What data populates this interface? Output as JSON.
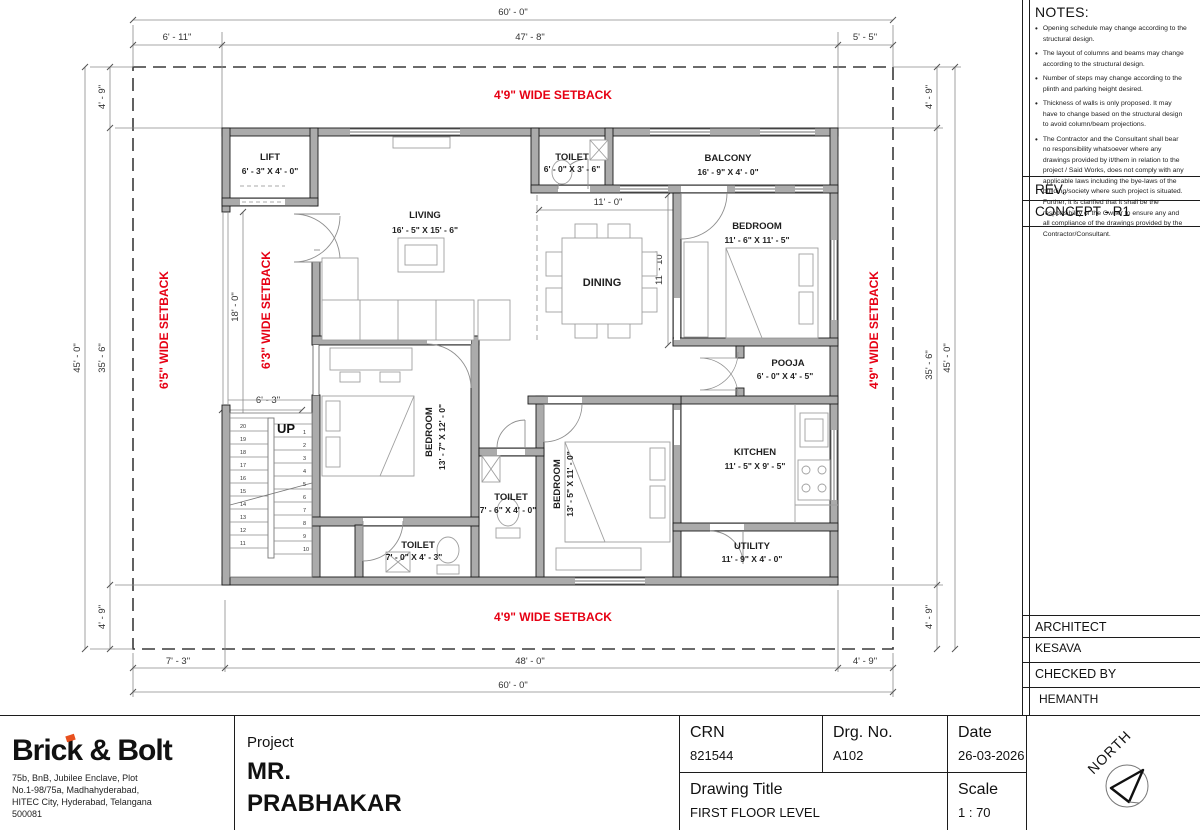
{
  "notes": {
    "title": "NOTES:",
    "items": [
      "Opening schedule may change according to the structural design.",
      "The layout of columns and beams may change according to the structural design.",
      "Number of steps may change according to the plinth and parking height desired.",
      "Thickness of walls is only proposed. It may have to change based on the structural design to avoid column/beam projections.",
      "The Contractor and the Consultant shall bear no responsibility whatsoever where any drawings provided by it/them in relation to the project / Said Works, does not comply with any applicable laws including the bye-laws of the building/society where such project is situated. Further, it is clarified that it shall be the responsibility of the Owner to ensure any and all compliance of the drawings provided by the Contractor/Consultant."
    ]
  },
  "rev": {
    "label": "REV.",
    "value": "CONCEPT - R1"
  },
  "architect": {
    "label": "ARCHITECT",
    "value": "KESAVA"
  },
  "checked_by": {
    "label": "CHECKED BY",
    "value": "HEMANTH"
  },
  "title_block": {
    "company": "Brick & Bolt",
    "address": "75b, BnB, Jubilee Enclave, Plot\nNo.1-98/75a, Madhahyderabad,\nHITEC City, Hyderabad, Telangana\n500081",
    "project_label": "Project",
    "project_name_line1": "MR.",
    "project_name_line2": "PRABHAKAR",
    "crn_label": "CRN",
    "crn_value": "821544",
    "drg_label": "Drg. No.",
    "drg_value": "A102",
    "date_label": "Date",
    "date_value": "26-03-2026",
    "drawing_title_label": "Drawing Title",
    "drawing_title_value": "FIRST FLOOR LEVEL",
    "scale_label": "Scale",
    "scale_value": "1 : 70",
    "north_label": "NORTH"
  },
  "plan": {
    "rooms": {
      "lift": {
        "name": "LIFT",
        "dim": "6' - 3\" X 4' - 0\""
      },
      "living": {
        "name": "LIVING",
        "dim": "16' - 5\" X 15' - 6\""
      },
      "toilet_top": {
        "name": "TOILET",
        "dim": "6' - 0\" X 3' - 6\""
      },
      "balcony": {
        "name": "BALCONY",
        "dim": "16' - 9\" X 4' - 0\""
      },
      "bedroom1": {
        "name": "BEDROOM",
        "dim": "11' - 6\" X 11' - 5\""
      },
      "dining": {
        "name": "DINING"
      },
      "pooja": {
        "name": "POOJA",
        "dim": "6' - 0\" X 4' - 5\""
      },
      "kitchen": {
        "name": "KITCHEN",
        "dim": "11' - 5\" X 9' - 5\""
      },
      "bedroom2": {
        "name": "BEDROOM",
        "dim": "13' - 7\" X 12' - 0\""
      },
      "toilet_mid": {
        "name": "TOILET",
        "dim": "7' - 6\" X 4' - 0\""
      },
      "bedroom3": {
        "name": "BEDROOM",
        "dim": "13' - 5\" X 11' - 0\""
      },
      "toilet_bottom": {
        "name": "TOILET",
        "dim": "7' - 0\" X 4' - 3\""
      },
      "utility": {
        "name": "UTILITY",
        "dim": "11' - 9\" X 4' - 0\""
      }
    },
    "setbacks": {
      "top": "4'9\" WIDE SETBACK",
      "bottom": "4'9\" WIDE SETBACK",
      "left": "6'5\" WIDE SETBACK",
      "inner_left": "6'3\" WIDE SETBACK",
      "right": "4'9\" WIDE SETBACK"
    },
    "dims": {
      "top_total": "60' - 0\"",
      "top_left": "6' - 11\"",
      "top_mid": "47' - 8\"",
      "top_right": "5' - 5\"",
      "left_outer": "45' - 0\"",
      "left_inner": "35' - 6\"",
      "left_top": "4' - 9\"",
      "left_bottom": "4' - 9\"",
      "right_outer": "45' - 0\"",
      "right_inner": "35' - 6\"",
      "right_top": "4' - 9\"",
      "right_bottom": "4' - 9\"",
      "bottom_left": "7' - 3\"",
      "bottom_mid": "48' - 0\"",
      "bottom_right": "4' - 9\"",
      "bottom_total": "60' - 0\"",
      "hall_w": "11' - 0\"",
      "hall_h": "11' - 10\"",
      "porch_h": "18' - 0\"",
      "porch_w": "6' - 3\""
    },
    "stairs": {
      "up_label": "UP",
      "left_numbers": [
        "20",
        "19",
        "18",
        "17",
        "16",
        "15",
        "14",
        "13",
        "12",
        "11"
      ],
      "right_numbers": [
        "1",
        "2",
        "3",
        "4",
        "5",
        "6",
        "7",
        "8",
        "9",
        "10"
      ]
    },
    "colors": {
      "accent_red": "#e60013",
      "wall_gray": "#ababab"
    }
  }
}
